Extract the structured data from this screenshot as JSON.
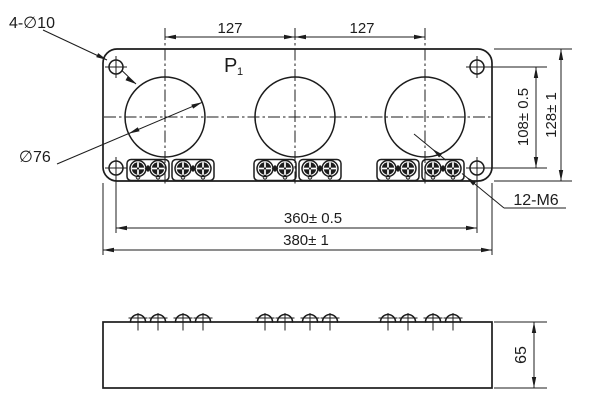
{
  "drawing": {
    "top_view": {
      "label_holes": "4-∅10",
      "label_circle_dia": "∅76",
      "label_thread": "12-M6",
      "label_p": "P",
      "label_p_sub": "1",
      "dim_pitch_1": "127",
      "dim_pitch_2": "127",
      "dim_hole_v": "108± 0.5",
      "dim_height": "128± 1",
      "dim_mount_w": "360± 0.5",
      "dim_width": "380± 1"
    },
    "side_view": {
      "dim_height": "65"
    },
    "colors": {
      "line": "#1c1c1c",
      "background": "#ffffff"
    }
  }
}
